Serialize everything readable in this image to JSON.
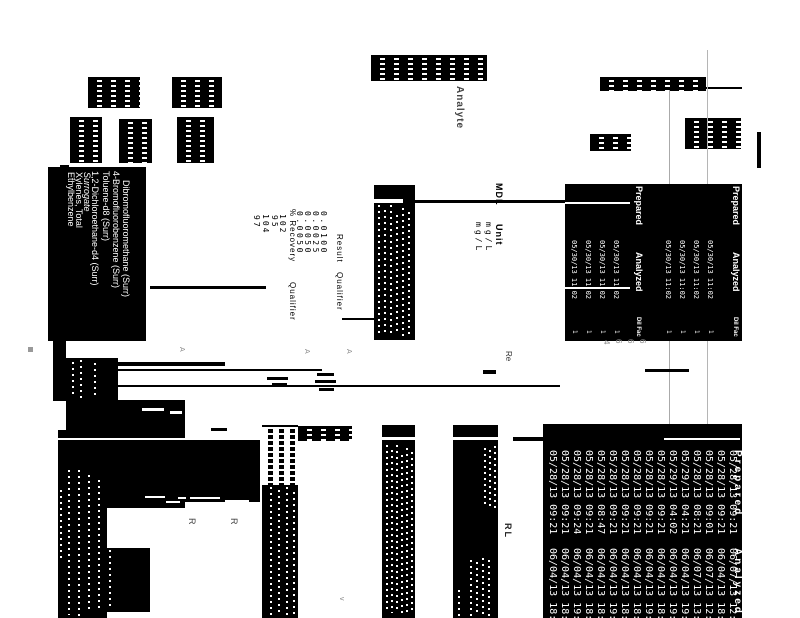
{
  "page": {
    "background": "#ffffff",
    "ink": "#000000",
    "faint_line_color": "#aaaaaa",
    "gray_text_color": "#888888"
  },
  "upper_table": {
    "analyte_header": "Analyte",
    "col_headers": {
      "result": "Result",
      "qualifier": "Qualifier",
      "pct_recovery": "% Recovery",
      "recovery_qualifier": "Qualifier",
      "mdl": "MDL",
      "unit": "Unit",
      "prepared": "Prepared",
      "analyzed": "Analyzed",
      "dil_fac": "Dil Fac"
    },
    "units": [
      "mg/L",
      "mg/L"
    ],
    "results": [
      "0.0050",
      "0.0050",
      "0.0025",
      "0.0100"
    ],
    "recoveries": [
      "97",
      "104",
      "95",
      "102"
    ],
    "analytes": [
      "Ethylbenzene",
      "Xylenes, Total"
    ],
    "surrogate_section_label": "Surrogate",
    "surrogates": [
      "1,2-Dichloroethane-d4 (Surr)",
      "Toluene-d8 (Surr)",
      "4-Bromofluorobenzene (Surr)",
      "Dibromofluoromethane (Surr)"
    ],
    "analyzed_dates": [
      "05/30/13 11:02",
      "05/30/13 11:02",
      "05/30/13 11:02",
      "05/30/13 11:02",
      "05/30/13 11:02",
      "05/30/13 11:02",
      "05/30/13 11:02",
      "05/30/13 11:02"
    ],
    "dil_factors": [
      "1",
      "1",
      "1",
      "1",
      "1",
      "1",
      "1",
      "1"
    ]
  },
  "bottom_table": {
    "prepared_header": "Prepared",
    "analyzed_header": "Analyzed",
    "rl_header": "RL",
    "re_label": "Re",
    "qualifier_flags": [
      "R",
      "R"
    ],
    "prepared_dates": [
      "05/28/13 09:21",
      "05/28/13 09:21",
      "05/28/13 09:24",
      "05/28/13 09:21",
      "05/28/13 08:47",
      "05/28/13 09:21",
      "05/28/13 09:21",
      "05/28/13 09:21",
      "05/28/13 09:21",
      "05/28/13 09:21",
      "05/29/13 04:02",
      "05/29/13 04:21",
      "05/28/13 08:21",
      "05/28/13 09:01",
      "05/28/13 09:21",
      "05/28/13 09:21"
    ],
    "analyzed_dates": [
      "06/04/13 18:45",
      "06/04/13 18:45",
      "06/04/13 19:13",
      "06/04/13 18:45",
      "06/04/13 18:18",
      "06/04/13 19:45",
      "06/04/13 18:45",
      "06/04/13 18:45",
      "06/04/13 19:45",
      "06/04/13 18:45",
      "06/04/13 19:10",
      "06/04/13 19:45",
      "06/07/13 13:45",
      "06/07/13 12:45",
      "06/04/13 18:45",
      "06/07/13 12:02"
    ],
    "footnote_marks": [
      "4",
      "6",
      "6",
      "6"
    ],
    "stray_marks": [
      "A",
      "A",
      "A",
      "v"
    ]
  }
}
